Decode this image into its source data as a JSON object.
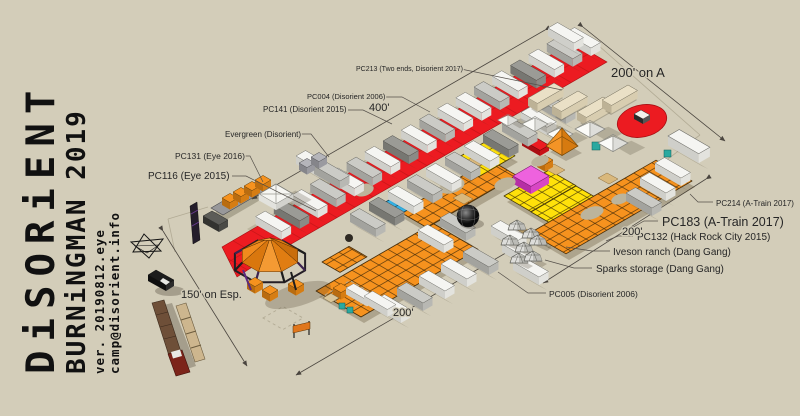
{
  "masthead": {
    "title": "DiSORiENT",
    "subtitle": "BURNiNGMAN 2019",
    "version": "ver. 20190812.eye",
    "email": "camp@disorient.info"
  },
  "annotations": {
    "pc213": "PC213 (Two ends, Disorient 2017)",
    "pc004": "PC004 (Disorient 2006)",
    "pc141": "PC141 (Disorient 2015)",
    "evergreen": "Evergreen (Disorient)",
    "pc131": "PC131 (Eye 2016)",
    "pc116": "PC116 (Eye 2015)",
    "pc214": "PC214 (A-Train 2017)",
    "pc183": "PC183 (A-Train 2017)",
    "pc132": "PC132 (Hack Rock City 2015)",
    "iveson": "Iveson ranch (Dang Gang)",
    "sparks": "Sparks storage (Dang Gang)",
    "pc005": "PC005 (Disorient 2006)"
  },
  "dimensions": {
    "on_a": "200' on A",
    "nw": "400'",
    "se": "200'",
    "south": "200'",
    "esp": "150' on Esp."
  },
  "colors": {
    "ground": "#d3cdb9",
    "road_red": "#ec1b21",
    "tile_orange": "#f6921e",
    "tile_yellow": "#ffe10a",
    "tile_blue": "#33b1e6",
    "tile_magenta": "#e653d6"
  }
}
